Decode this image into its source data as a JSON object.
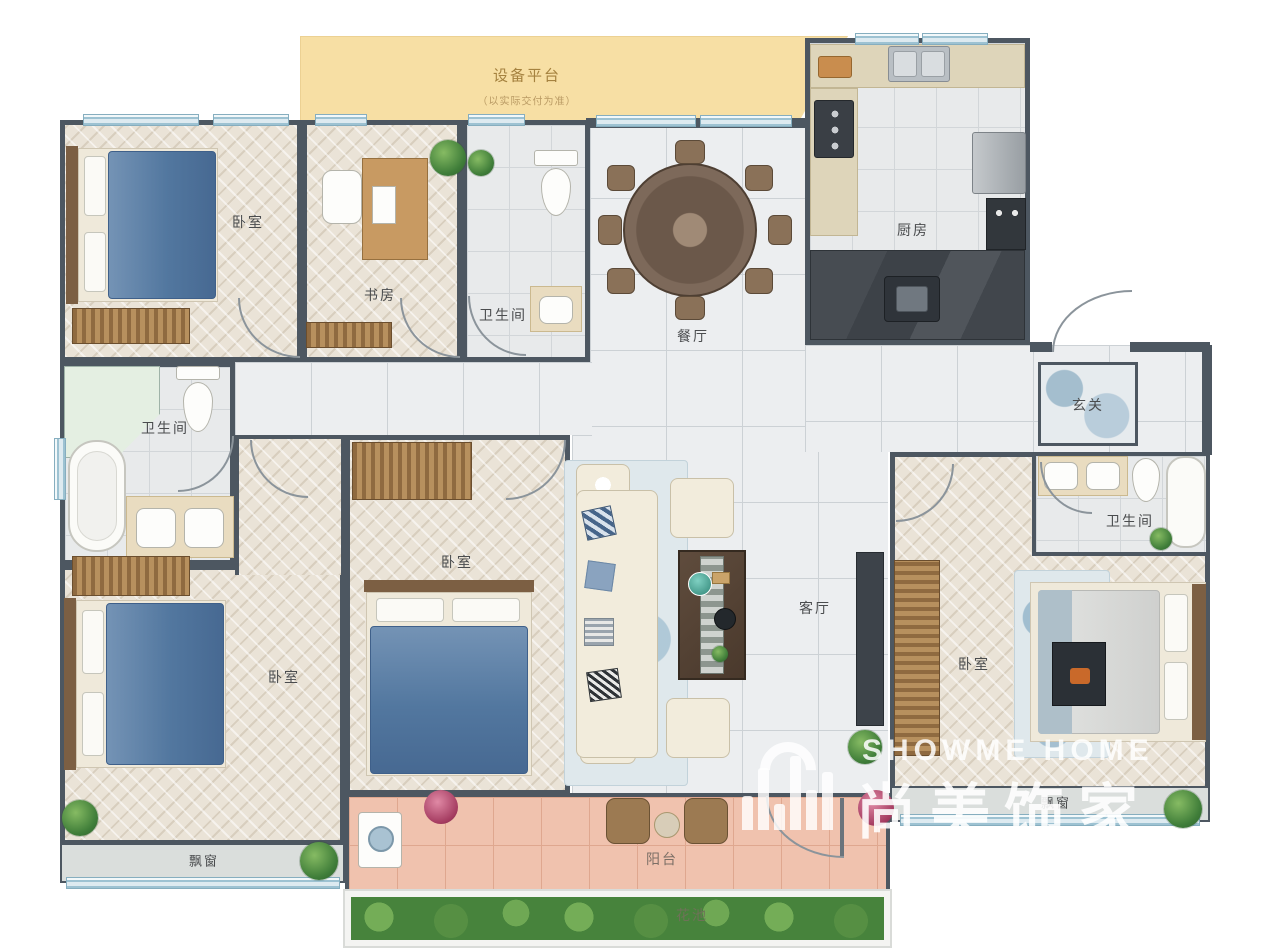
{
  "platform": {
    "label": "设备平台",
    "sublabel": "（以实际交付为准）"
  },
  "rooms": [
    {
      "id": "bedroom-top-left",
      "label": "卧室"
    },
    {
      "id": "study",
      "label": "书房"
    },
    {
      "id": "bathroom-top",
      "label": "卫生间"
    },
    {
      "id": "dining-room",
      "label": "餐厅"
    },
    {
      "id": "kitchen",
      "label": "厨房"
    },
    {
      "id": "foyer",
      "label": "玄关"
    },
    {
      "id": "bathroom-left",
      "label": "卫生间"
    },
    {
      "id": "bedroom-middle",
      "label": "卧室"
    },
    {
      "id": "bedroom-bottom-left",
      "label": "卧室"
    },
    {
      "id": "living-room",
      "label": "客厅"
    },
    {
      "id": "bathroom-right",
      "label": "卫生间"
    },
    {
      "id": "bedroom-right",
      "label": "卧室"
    },
    {
      "id": "bay-window-left",
      "label": "飘窗"
    },
    {
      "id": "bay-window-right",
      "label": "飘窗"
    },
    {
      "id": "balcony",
      "label": "阳台"
    },
    {
      "id": "flower-bed",
      "label": "花池"
    }
  ],
  "watermark": {
    "brand_en": "SHOWME HOME",
    "brand_cn": "尚美饰家"
  },
  "palette": {
    "wall": "#4d5761",
    "platform_fill": "#f7dfa4",
    "platform_text": "#a5823f",
    "herringbone_floor": "#eae3d7",
    "marble_floor": "#eceef0",
    "balcony_floor": "#f0c2ae",
    "flower_bed_green": "#47833c",
    "window_blue": "#9dc2d2",
    "bed_blue": "#52779f",
    "wood": "#b7905e",
    "watermark_white": "#ffffff"
  }
}
